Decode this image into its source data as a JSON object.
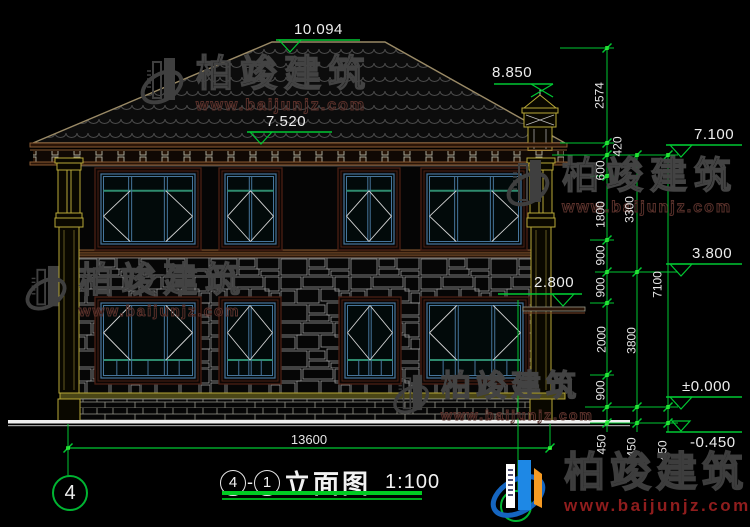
{
  "watermark": {
    "brand": "柏竣建筑",
    "url": "www.baijunjz.com"
  },
  "logo": {
    "brand": "柏竣建筑",
    "url": "www.baijunjz.com"
  },
  "title": {
    "grid_start": "4",
    "dash": "-",
    "grid_end": "1",
    "name": "立面图",
    "scale": "1:100"
  },
  "grid": {
    "bubble_left": "4"
  },
  "elevations": {
    "ridge": "10.094",
    "eave": "7.520",
    "chimney": "8.850",
    "second_roof": "7.100",
    "second_floor": "3.800",
    "canopy": "2.800",
    "zero": "±0.000",
    "grade": "-0.450"
  },
  "dims": {
    "overall_width": "13600",
    "inner": [
      "2574",
      "420",
      "600",
      "1800",
      "900",
      "900",
      "2000",
      "900",
      "450"
    ],
    "mid": [
      "3300",
      "3800",
      "450"
    ],
    "outer": [
      "7100",
      "450"
    ]
  }
}
